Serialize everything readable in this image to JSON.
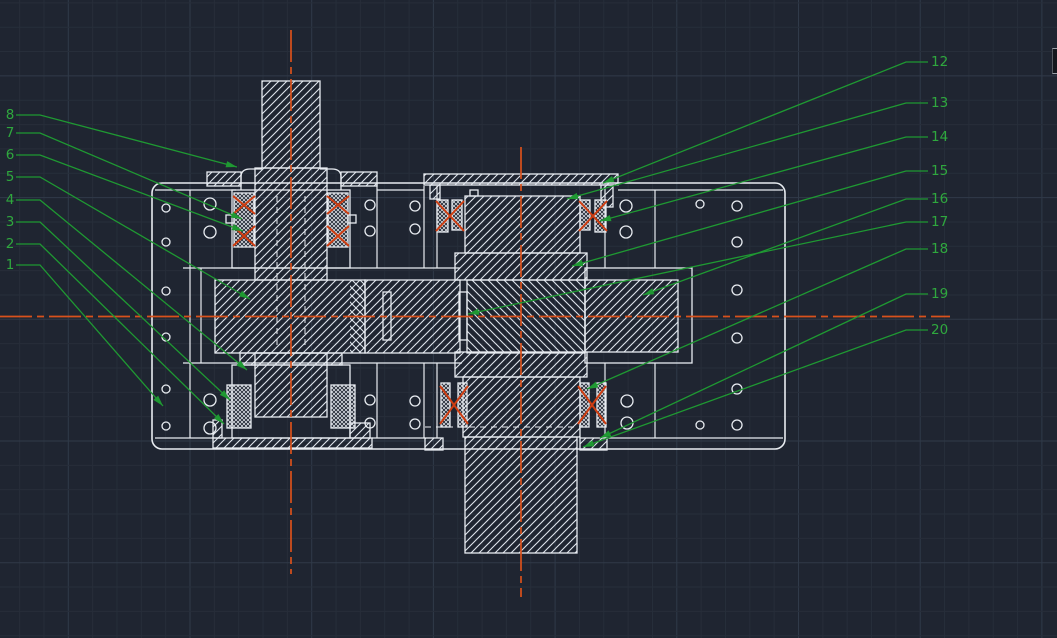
{
  "app": {
    "name": "cad-model-space",
    "description": "CAD drawing canvas showing a worm gearbox assembly section with part callouts",
    "colors": {
      "background": "#1f2531",
      "grid_minor": "#272e3a",
      "grid_major": "#303a49",
      "outline_white": "#e8ecf1",
      "leader_green": "#1f9932",
      "label_green": "#2fa83e",
      "centerline_orange": "#d9511c",
      "bearing_mark_red": "#cf3d11"
    }
  },
  "canvas": {
    "width": 1057,
    "height": 638
  },
  "grid": {
    "origin_x": 68.3,
    "origin_y": 75.9,
    "step": 24.34,
    "major_every": 5
  },
  "centerlines": [
    [
      291,
      30,
      291,
      574
    ],
    [
      521,
      147,
      521,
      597
    ],
    [
      0,
      316.5,
      950,
      316.5
    ]
  ],
  "callouts": {
    "left": [
      {
        "label": "1",
        "label_x": 10,
        "y": 265,
        "elbow_x": 40,
        "target": [
          163,
          406
        ]
      },
      {
        "label": "2",
        "label_x": 10,
        "y": 244,
        "elbow_x": 40,
        "target": [
          224,
          424
        ]
      },
      {
        "label": "3",
        "label_x": 10,
        "y": 222,
        "elbow_x": 40,
        "target": [
          230,
          400
        ]
      },
      {
        "label": "4",
        "label_x": 10,
        "y": 200,
        "elbow_x": 40,
        "target": [
          247,
          370
        ]
      },
      {
        "label": "5",
        "label_x": 10,
        "y": 177,
        "elbow_x": 40,
        "target": [
          250,
          299
        ]
      },
      {
        "label": "6",
        "label_x": 10,
        "y": 155,
        "elbow_x": 40,
        "target": [
          243,
          231
        ]
      },
      {
        "label": "7",
        "label_x": 10,
        "y": 133,
        "elbow_x": 40,
        "target": [
          242,
          219
        ]
      },
      {
        "label": "8",
        "label_x": 10,
        "y": 115,
        "elbow_x": 40,
        "target": [
          237,
          167
        ]
      }
    ],
    "right": [
      {
        "label": "12",
        "label_x": 931,
        "y": 62,
        "elbow_x": 906,
        "dash_x": 928,
        "target": [
          603,
          183
        ]
      },
      {
        "label": "13",
        "label_x": 931,
        "y": 103,
        "elbow_x": 906,
        "dash_x": 928,
        "target": [
          567,
          199
        ]
      },
      {
        "label": "14",
        "label_x": 931,
        "y": 137,
        "elbow_x": 906,
        "dash_x": 928,
        "target": [
          600,
          221
        ]
      },
      {
        "label": "15",
        "label_x": 931,
        "y": 171,
        "elbow_x": 906,
        "dash_x": 928,
        "target": [
          572,
          266
        ]
      },
      {
        "label": "16",
        "label_x": 931,
        "y": 199,
        "elbow_x": 906,
        "dash_x": 928,
        "target": [
          643,
          295
        ]
      },
      {
        "label": "17",
        "label_x": 931,
        "y": 222,
        "elbow_x": 906,
        "dash_x": 928,
        "target": [
          468,
          314
        ]
      },
      {
        "label": "18",
        "label_x": 931,
        "y": 249,
        "elbow_x": 906,
        "dash_x": 928,
        "target": [
          587,
          389
        ]
      },
      {
        "label": "19",
        "label_x": 931,
        "y": 294,
        "elbow_x": 906,
        "dash_x": 928,
        "target": [
          600,
          438
        ]
      },
      {
        "label": "20",
        "label_x": 931,
        "y": 330,
        "elbow_x": 906,
        "dash_x": 928,
        "target": [
          583,
          447
        ]
      }
    ]
  },
  "drawing": {
    "housing": {
      "x": 152,
      "y": 183,
      "w": 633,
      "h": 266,
      "r": 10
    },
    "rects": [
      [
        262,
        81,
        58,
        87,
        "f"
      ],
      [
        255,
        168,
        72,
        112,
        "f"
      ],
      [
        207,
        172,
        34,
        14,
        "f"
      ],
      [
        341,
        172,
        36,
        14,
        "f"
      ],
      [
        232,
        190,
        118,
        78,
        "n"
      ],
      [
        234,
        193,
        20,
        54,
        "x"
      ],
      [
        328,
        193,
        20,
        54,
        "x"
      ],
      [
        226,
        215,
        8,
        8,
        "n"
      ],
      [
        348,
        215,
        8,
        8,
        "n"
      ],
      [
        215,
        280,
        150,
        73,
        "f"
      ],
      [
        350,
        280,
        15,
        73,
        "bo"
      ],
      [
        240,
        353,
        102,
        12,
        "f"
      ],
      [
        232,
        365,
        118,
        73,
        "n"
      ],
      [
        227,
        385,
        24,
        43,
        "x"
      ],
      [
        331,
        385,
        24,
        43,
        "x"
      ],
      [
        255,
        353,
        72,
        64,
        "f"
      ],
      [
        213,
        438,
        159,
        10,
        "f"
      ],
      [
        213,
        420,
        9,
        18,
        "f"
      ],
      [
        350,
        423,
        20,
        15,
        "f"
      ],
      [
        424,
        174,
        194,
        11,
        "f"
      ],
      [
        430,
        185,
        10,
        14,
        "f"
      ],
      [
        601,
        185,
        12,
        22,
        "f"
      ],
      [
        437,
        200,
        11,
        32,
        "x"
      ],
      [
        452,
        200,
        10,
        30,
        "x"
      ],
      [
        580,
        200,
        10,
        30,
        "x"
      ],
      [
        595,
        200,
        11,
        32,
        "x"
      ],
      [
        465,
        196,
        115,
        57,
        "f"
      ],
      [
        470,
        190,
        8,
        6,
        "n"
      ],
      [
        455,
        253,
        132,
        27,
        "f"
      ],
      [
        365,
        280,
        95,
        73,
        "f"
      ],
      [
        383,
        292,
        8,
        48,
        "n"
      ],
      [
        459,
        292,
        8,
        48,
        "n"
      ],
      [
        467,
        280,
        118,
        73,
        "b"
      ],
      [
        585,
        268,
        107,
        95,
        "n"
      ],
      [
        585,
        280,
        93,
        72,
        "f"
      ],
      [
        455,
        352,
        132,
        25,
        "f"
      ],
      [
        463,
        377,
        117,
        60,
        "f"
      ],
      [
        441,
        383,
        9,
        44,
        "x"
      ],
      [
        458,
        383,
        9,
        44,
        "x"
      ],
      [
        580,
        383,
        9,
        44,
        "x"
      ],
      [
        597,
        383,
        9,
        44,
        "x"
      ],
      [
        425,
        438,
        18,
        12,
        "f"
      ],
      [
        580,
        438,
        27,
        12,
        "f"
      ],
      [
        465,
        437,
        112,
        116,
        "f"
      ]
    ],
    "lines": [
      [
        155,
        190,
        236,
        190
      ],
      [
        377,
        190,
        424,
        190
      ],
      [
        618,
        190,
        783,
        190
      ],
      [
        155,
        438,
        213,
        438
      ],
      [
        372,
        438,
        425,
        438
      ],
      [
        607,
        438,
        783,
        438
      ],
      [
        190,
        190,
        190,
        438
      ],
      [
        201,
        268,
        201,
        363
      ],
      [
        655,
        190,
        655,
        268
      ],
      [
        655,
        363,
        655,
        438
      ],
      [
        377,
        183,
        377,
        268
      ],
      [
        377,
        363,
        377,
        438
      ],
      [
        424,
        186,
        424,
        268
      ],
      [
        424,
        363,
        424,
        438
      ],
      [
        437,
        186,
        437,
        268
      ],
      [
        605,
        186,
        605,
        268
      ],
      [
        437,
        363,
        437,
        438
      ],
      [
        605,
        363,
        605,
        438
      ],
      [
        183,
        268,
        460,
        268
      ],
      [
        183,
        363,
        462,
        363
      ]
    ],
    "dashed_lines": [
      [
        277,
        196,
        277,
        348
      ],
      [
        305,
        196,
        305,
        348
      ],
      [
        425,
        427,
        580,
        427
      ]
    ],
    "paths": [
      "M241,190 L241,177 Q241,169 250,169 L262,169",
      "M341,190 L341,177 Q341,169 332,169 L320,169"
    ],
    "circles": [
      [
        166,
        208,
        4
      ],
      [
        166,
        242,
        4
      ],
      [
        210,
        204,
        6
      ],
      [
        210,
        232,
        6
      ],
      [
        370,
        205,
        5
      ],
      [
        370,
        231,
        5
      ],
      [
        415,
        206,
        5
      ],
      [
        415,
        229,
        5
      ],
      [
        626,
        206,
        6
      ],
      [
        626,
        232,
        6
      ],
      [
        700,
        204,
        4
      ],
      [
        737,
        206,
        5
      ],
      [
        737,
        242,
        5
      ],
      [
        166,
        291,
        4
      ],
      [
        166,
        337,
        4
      ],
      [
        737,
        290,
        5
      ],
      [
        737,
        338,
        5
      ],
      [
        166,
        389,
        4
      ],
      [
        166,
        426,
        4
      ],
      [
        210,
        400,
        6
      ],
      [
        210,
        428,
        6
      ],
      [
        370,
        400,
        5
      ],
      [
        370,
        423,
        5
      ],
      [
        415,
        401,
        5
      ],
      [
        415,
        424,
        5
      ],
      [
        627,
        401,
        6
      ],
      [
        627,
        423,
        6
      ],
      [
        700,
        425,
        4
      ],
      [
        737,
        389,
        5
      ],
      [
        737,
        425,
        5
      ]
    ],
    "bearing_marks": [
      [
        233,
        196,
        22,
        18
      ],
      [
        233,
        226,
        22,
        20
      ],
      [
        327,
        196,
        22,
        18
      ],
      [
        327,
        226,
        22,
        20
      ],
      [
        436,
        201,
        28,
        30
      ],
      [
        579,
        201,
        28,
        30
      ],
      [
        440,
        386,
        28,
        38
      ],
      [
        578,
        386,
        28,
        38
      ]
    ]
  },
  "ui": {
    "panel_sliver": {
      "x": 1052,
      "y": 48,
      "w": 5,
      "h": 26
    }
  }
}
